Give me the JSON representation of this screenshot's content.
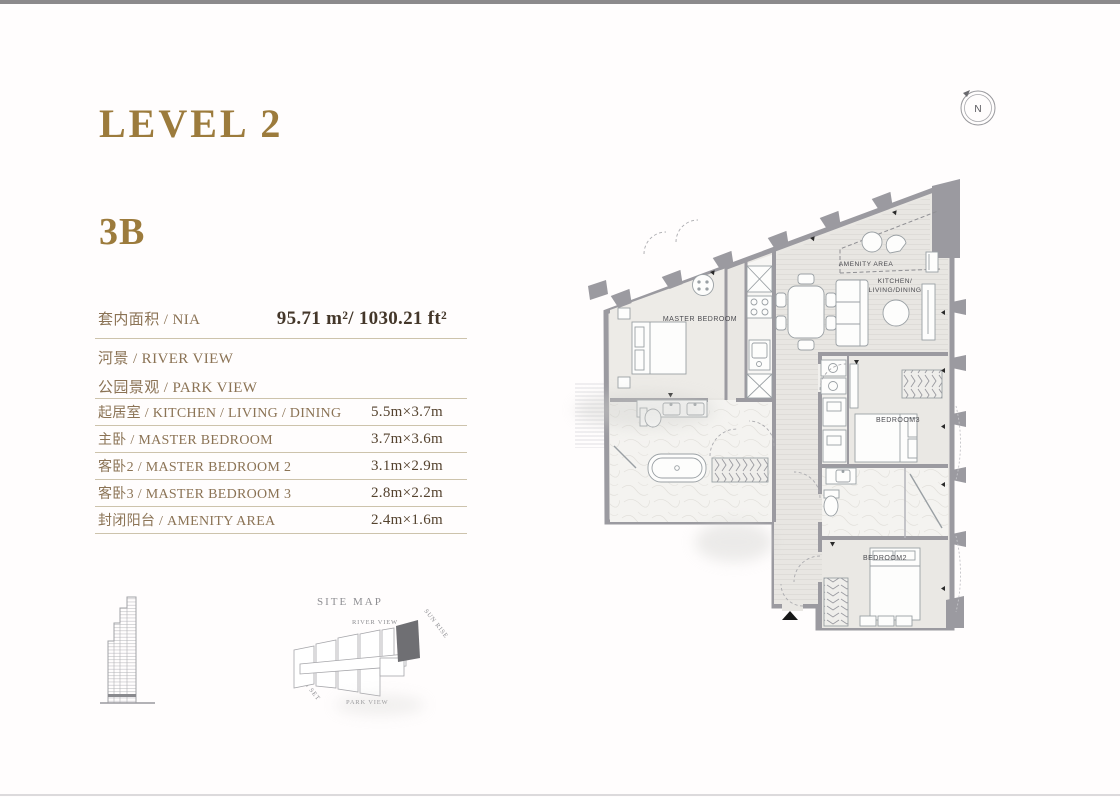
{
  "page": {
    "level_title": "LEVEL 2",
    "unit_title": "3B",
    "compass": "N"
  },
  "info": {
    "nia_label": "套内面积 / NIA",
    "nia_value": "95.71 m²/ 1030.21 ft²",
    "view1": "河景 / RIVER VIEW",
    "view2": "公园景观 / PARK VIEW"
  },
  "rooms": [
    {
      "label": "起居室 / KITCHEN / LIVING / DINING",
      "size": "5.5m×3.7m"
    },
    {
      "label": "主卧 / MASTER BEDROOM",
      "size": "3.7m×3.6m"
    },
    {
      "label": "客卧2 / MASTER BEDROOM 2",
      "size": "3.1m×2.9m"
    },
    {
      "label": "客卧3 / MASTER BEDROOM 3",
      "size": "2.8m×2.2m"
    },
    {
      "label": "封闭阳台 / AMENITY AREA",
      "size": "2.4m×1.6m"
    }
  ],
  "floor_plan": {
    "master_bedroom": "MASTER BEDROOM",
    "amenity_area": "AMENITY AREA",
    "kitchen_line1": "KITCHEN/",
    "kitchen_line2": "LIVING/DINING",
    "bedroom3": "BEDROOM3",
    "bedroom2": "BEDROOM2"
  },
  "site_map": {
    "title": "SITE MAP",
    "river_view": "RIVER VIEW",
    "park_view": "PARK VIEW",
    "sun_rise": "SUN RISE",
    "sun_set": "SUN SET"
  },
  "colors": {
    "accent_gold": "#9c7b3c",
    "label_brown": "#8b7355",
    "value_brown": "#44372a",
    "rule_tan": "#cdc3ac",
    "wall_gray": "#9b9aa0",
    "site_highlight": "#6f6f73"
  }
}
